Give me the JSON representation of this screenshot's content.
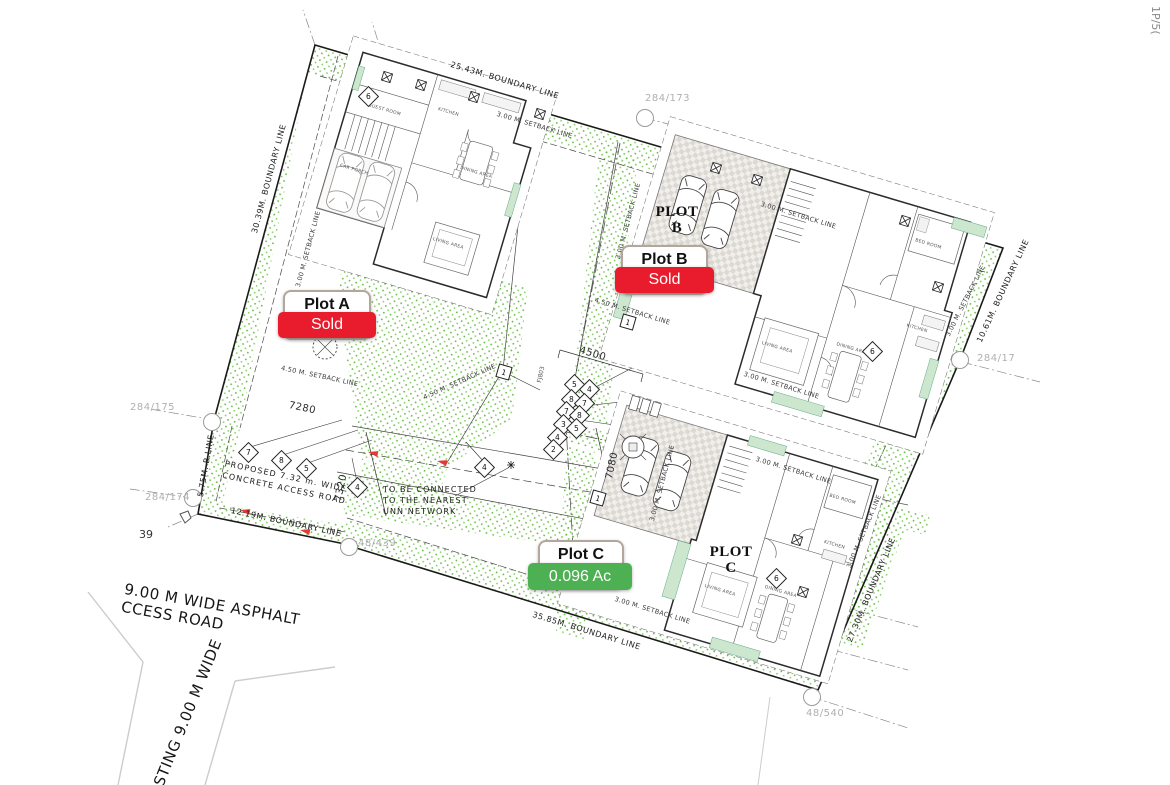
{
  "cards": {
    "a": {
      "title": "Plot A",
      "status": "Sold"
    },
    "b": {
      "title": "Plot B",
      "status": "Sold"
    },
    "c": {
      "title": "Plot C",
      "status": "0.096 Ac"
    }
  },
  "plan_labels": {
    "plot_b_line1": "PLOT",
    "plot_b_line2": "B",
    "plot_c_line1": "PLOT",
    "plot_c_line2": "C"
  },
  "boundaries": {
    "top": "25.43M. BOUNDARY LINE",
    "left": "30.39M. BOUNDARY LINE",
    "left_short": "5.75M. B.LINE",
    "bottom_left": "12.19M. BOUNDARY LINE",
    "bottom": "35.85M. BOUNDARY LINE",
    "right": "27.30M. BOUNDARY LINE",
    "top_right": "10.61M. BOUNDARY LINE"
  },
  "setbacks": {
    "s300": "3.00 M. SETBACK LINE",
    "s450": "4.50 M. SETBACK LINE"
  },
  "refs": {
    "r284_173": "284/173",
    "r284_175": "284/175",
    "r284_174": "284/174",
    "r284_17": "284/17",
    "r48_439": "48/439",
    "r48_540": "48/540",
    "r39": "39",
    "sheet": "1P/5(",
    "fj": "FJ803"
  },
  "dims": {
    "d7280": "7280",
    "d7320": "7320",
    "d4500": "4500",
    "d7080": "7080"
  },
  "notes": {
    "road1": "PROPOSED 7.32 m. WIDE",
    "road2": "CONCRETE ACCESS ROAD",
    "unn1": "TO BE CONNECTED",
    "unn2": "TO THE NEAREST",
    "unn3": "UNN NETWORK",
    "asphalt1": "9.00 M WIDE ASPHALT",
    "asphalt2": "CCESS ROAD",
    "existing": "STING 9.00 M WIDE"
  },
  "keys": {
    "k1": "1",
    "k2": "2",
    "k3": "3",
    "k4": "4",
    "k5": "5",
    "k6": "6",
    "k7": "7",
    "k8": "8"
  },
  "rooms": {
    "kitchen": "KITCHEN",
    "dining": "DINING AREA",
    "living": "LIVING AREA",
    "guest": "GUEST ROOM",
    "carporch": "CAR PORCH",
    "bed": "BED ROOM"
  },
  "colors": {
    "sold": "#e81c2c",
    "available": "#4db052",
    "stipple": "#69be4a"
  }
}
